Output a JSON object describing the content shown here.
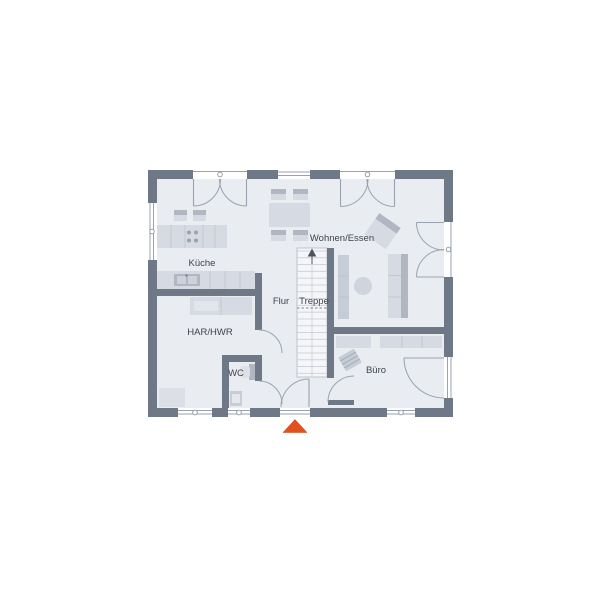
{
  "floor_plan": {
    "type": "ground-floor-plan",
    "rooms": [
      {
        "name": "kueche",
        "label": "Küche"
      },
      {
        "name": "wohnen-essen",
        "label": "Wohnen/Essen"
      },
      {
        "name": "flur",
        "label": "Flur"
      },
      {
        "name": "treppe",
        "label": "Treppe"
      },
      {
        "name": "har-hwr",
        "label": "HAR/HWR"
      },
      {
        "name": "wc",
        "label": "WC"
      },
      {
        "name": "buero",
        "label": "Büro"
      }
    ],
    "entrance_marker": "arrow-up",
    "colors": {
      "wall": "#6e7887",
      "floor": "#e9ecf1",
      "stair": "#f5f6f9",
      "flight": "#d6dbe3",
      "fmid": "#c7cdd7",
      "fdark": "#b0b7c3",
      "line": "#9aa2b0",
      "fdiv": "#bcc2cc",
      "text": "#3f444d",
      "arrow": "#e0511e",
      "tread": "#c9cdd5"
    }
  }
}
